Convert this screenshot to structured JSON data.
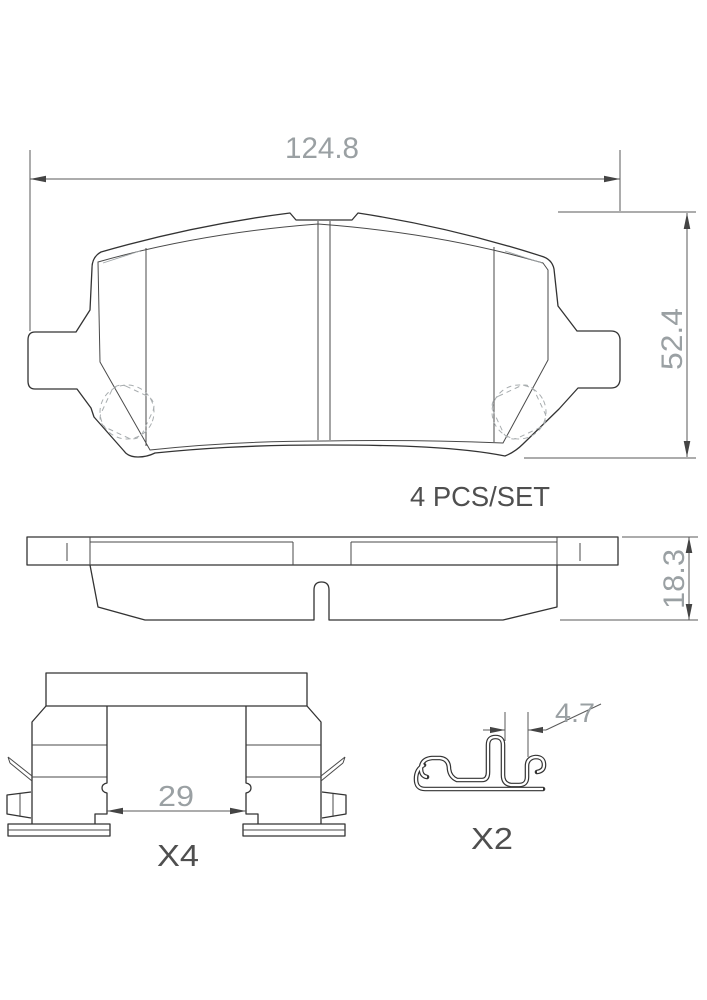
{
  "drawing": {
    "front_view": {
      "dim_width": "124.8",
      "dim_height": "52.4"
    },
    "set_label": "4 PCS/SET",
    "side_view": {
      "dim_thickness": "18.3"
    },
    "clip_view": {
      "dim_span": "29",
      "quantity": "X4"
    },
    "spring_view": {
      "dim_gap": "4.7",
      "quantity": "X2"
    },
    "colors": {
      "background": "#ffffff",
      "line": "#333333",
      "dimension_line": "#5a5a5a",
      "dimension_text": "#9aa0a3",
      "label_text": "#4f4f4f",
      "light_detail": "#a8adaf"
    }
  }
}
